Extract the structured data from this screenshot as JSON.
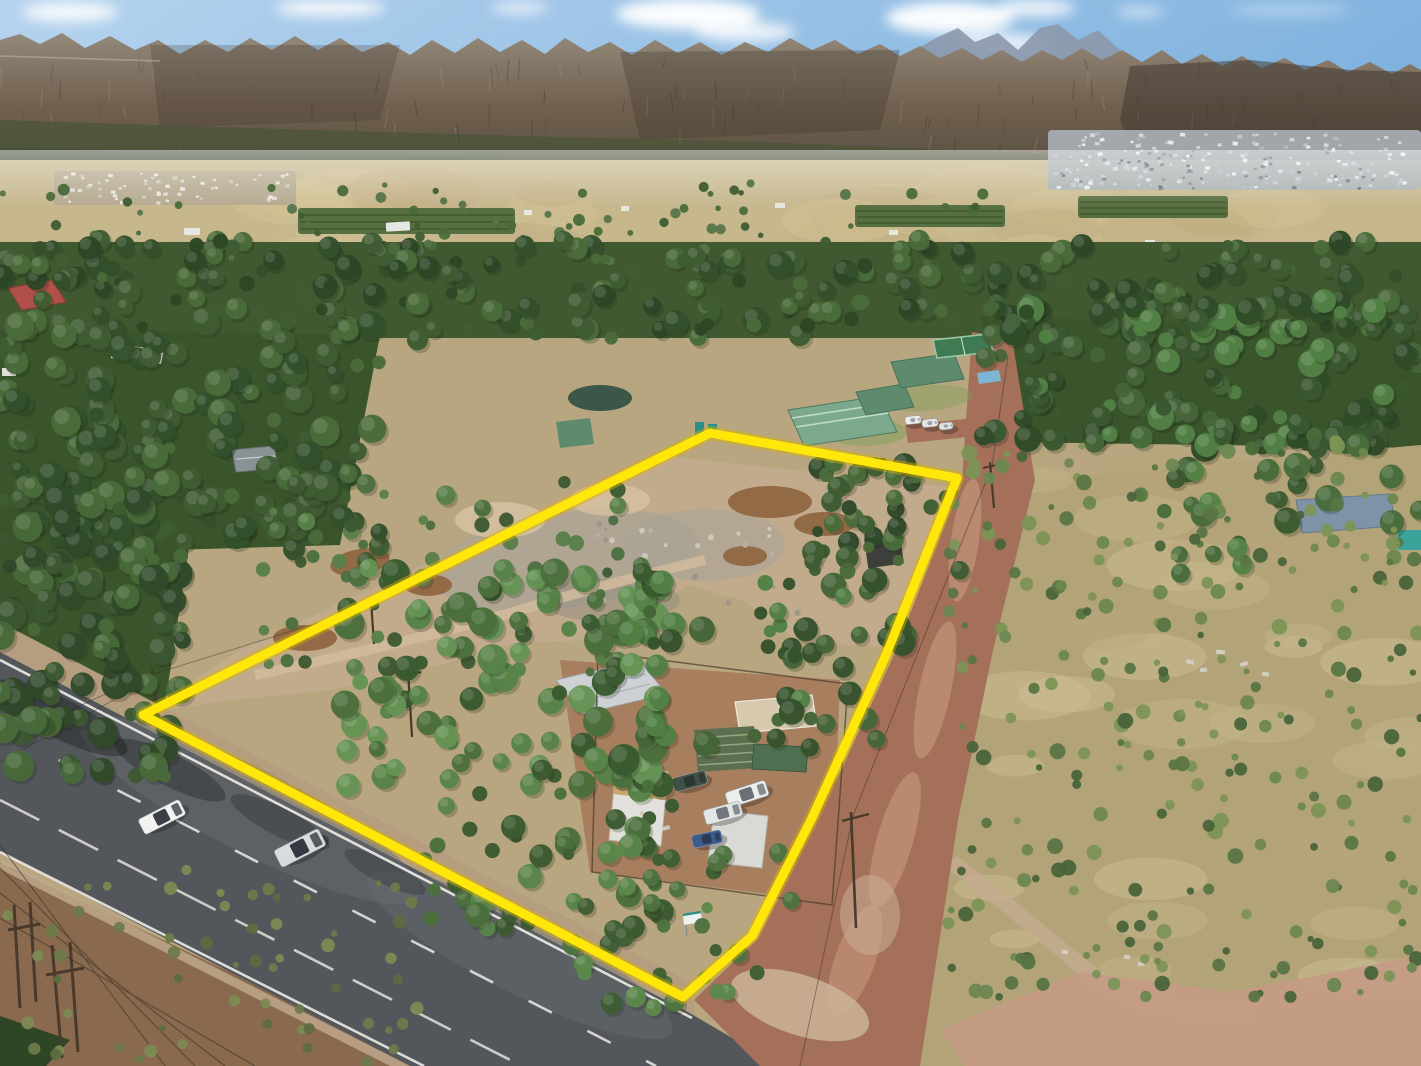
{
  "scene": {
    "description": "Aerial drone photograph of a rural smallholding outlined with a thick yellow boundary, beside a tarred main road with two cars, a red dirt road on the right, dense eucalyptus and pine trees, dry scrubland, green-roofed neighbouring farm buildings, and a long rocky mountain range with a town at its foot under a blue sky with clouds.",
    "type": "aerial-drone-photo"
  },
  "colors": {
    "sky_left": "#b6d3ee",
    "sky_right": "#7fb2de",
    "sky_low": "#cfe2f2",
    "cloud": "#ffffff",
    "peak_far": "#8c98ab",
    "mtn_top": "#93897a",
    "mtn_mid": "#71604f",
    "mtn_low": "#4e4a3b",
    "mtn_shadow": "#3c342b",
    "mtn_light": "#a79b88",
    "mtn_green": "#4a5438",
    "foothill": "#46513a",
    "valley_base": "#c6b78d",
    "orchard": "#566f40",
    "orchard_dark": "#42582f",
    "town_base": "#a9b0b6",
    "township_base": "#b5a98f",
    "ground_base": "#b7a67f",
    "forest_base": "#415930",
    "forest_base2": "#3a552c",
    "sand_clear": "#c2ab8d",
    "sand_gray": "#a9a396",
    "sand_light": "#d2bb9c",
    "heap": "#926b46",
    "mound": "#d8c4a4",
    "scrub_base": "#b3a379",
    "scrub_pink": "#c59b85",
    "scrub_path": "#c8ab93",
    "dirt_left": "#8a6a4f",
    "vineyard": "#2e4526",
    "tar": "#53575c",
    "tar_light": "#6a6e73",
    "tar_dark": "#43474c",
    "road_white": "#eceae4",
    "shoulder": "#b59d80",
    "gravel": "#c3ac90",
    "dirt_road": "#a4705a",
    "dirt_road_light": "#c89a7e",
    "dirt_road_pale": "#cbb49a",
    "roof_green": "#7ca98c",
    "roof_green_dark": "#5e8a6e",
    "court_green": "#3e7a52",
    "pool_blue": "#7db6d4",
    "lawn": "#7da05a",
    "roof_red": "#b05048",
    "roof_white": "#d8d8d2",
    "roof_gray": "#8b9296",
    "roof_silver": "#cdd1d4",
    "canvas_tan": "#d6c9ae",
    "rows_green": "#5c6e50",
    "shed_green": "#4f7050",
    "cottage_white": "#e2e0da",
    "cottage_roof": "#c8a76c",
    "caravan_white": "#d9dad5",
    "container_dark": "#3c3f3a",
    "pond": "#3c5648",
    "portaloo": "#2e8f86",
    "blue_roof": "#7e93a8",
    "teal_tank": "#3aa39a",
    "pole": "#4a3a2c",
    "wire": "#2f2a24",
    "shadow": "#1c2414",
    "boundary": "#ffe70a",
    "boundary_glow": "#d9b400",
    "sign_white": "#eef2f3",
    "sign_teal": "#2e8f86",
    "debris": "#d2cec4"
  },
  "boundary": {
    "points": "143,715 710,433 957,478 886,655 812,818 752,936 683,997",
    "stroke_width": 9,
    "glow_width": 14
  },
  "vehicles": {
    "road_cars": [
      {
        "name": "white-sedan-car",
        "x": 162,
        "y": 817,
        "angle": -27,
        "len": 46,
        "wid": 17,
        "body": "#f2f3f1",
        "glass": "#3a3f46"
      },
      {
        "name": "silver-suv-car",
        "x": 300,
        "y": 848,
        "angle": -27,
        "len": 50,
        "wid": 19,
        "body": "#d9dcdd",
        "glass": "#343a41"
      }
    ],
    "yard_vehicles": [
      {
        "name": "dark-green-car",
        "x": 690,
        "y": 781,
        "angle": -15,
        "len": 34,
        "wid": 14,
        "body": "#415047",
        "glass": "#2c3531"
      },
      {
        "name": "white-pickup-1",
        "x": 747,
        "y": 794,
        "angle": -18,
        "len": 42,
        "wid": 16,
        "body": "#eceeed",
        "glass": "#6b7076"
      },
      {
        "name": "white-pickup-2",
        "x": 723,
        "y": 813,
        "angle": -15,
        "len": 38,
        "wid": 15,
        "body": "#e3e6e5",
        "glass": "#70767c"
      },
      {
        "name": "blue-hatchback",
        "x": 707,
        "y": 839,
        "angle": -12,
        "len": 30,
        "wid": 13,
        "body": "#3c5c8e",
        "glass": "#2a3a52"
      }
    ],
    "neighbor_vehicles": [
      {
        "name": "white-car-1",
        "x": 913,
        "y": 420,
        "angle": -6,
        "len": 16,
        "wid": 8,
        "body": "#ececea",
        "glass": "#9aa0a4"
      },
      {
        "name": "white-car-2",
        "x": 930,
        "y": 423,
        "angle": -6,
        "len": 16,
        "wid": 8,
        "body": "#e4e6e6",
        "glass": "#9aa0a4"
      },
      {
        "name": "white-car-3",
        "x": 946,
        "y": 426,
        "angle": -6,
        "len": 14,
        "wid": 7,
        "body": "#dfe2e2",
        "glass": "#9aa0a4"
      }
    ]
  },
  "vegetation": {
    "regions": [
      {
        "layer": "bg-trees",
        "name": "valley-trees",
        "x": 0,
        "y": 183,
        "w": 1000,
        "h": 80,
        "count": 80,
        "rmin": 2.5,
        "rmax": 6,
        "seed": 11,
        "shape": "bush",
        "palette": [
          "#3f5c33",
          "#4a6b3a",
          "#55754a"
        ]
      },
      {
        "layer": "bg-trees",
        "name": "forest-band",
        "x": 0,
        "y": 240,
        "w": 1421,
        "h": 100,
        "count": 240,
        "rmin": 5,
        "rmax": 13,
        "seed": 12,
        "shape": "tree",
        "palette": [
          "#34502b",
          "#3f5c33",
          "#4a6b3a",
          "#2d4726"
        ]
      },
      {
        "layer": "bg-trees",
        "name": "forest-right-deep",
        "x": 980,
        "y": 300,
        "w": 441,
        "h": 150,
        "count": 150,
        "rmin": 6,
        "rmax": 14,
        "seed": 13,
        "shape": "tree",
        "palette": [
          "#3a5831",
          "#46653a",
          "#528044",
          "#2f4b28"
        ]
      },
      {
        "layer": "bg-trees",
        "name": "forest-left-deep",
        "x": 0,
        "y": 320,
        "w": 380,
        "h": 230,
        "count": 150,
        "rmin": 6,
        "rmax": 15,
        "seed": 14,
        "shape": "tree",
        "palette": [
          "#33512b",
          "#3f5c33",
          "#4a6b3a"
        ]
      },
      {
        "layer": "bg-trees",
        "name": "forest-left-road",
        "x": 0,
        "y": 500,
        "w": 190,
        "h": 280,
        "count": 95,
        "rmin": 6,
        "rmax": 16,
        "seed": 15,
        "shape": "tree",
        "palette": [
          "#31492a",
          "#3c5832",
          "#486939"
        ]
      },
      {
        "layer": "bg-trees",
        "name": "property-upper-strip",
        "x": 230,
        "y": 480,
        "w": 400,
        "h": 195,
        "count": 60,
        "rmin": 4,
        "rmax": 10,
        "seed": 16,
        "shape": "tree",
        "palette": [
          "#3e5a33",
          "#4c7040",
          "#5a8049"
        ]
      },
      {
        "layer": "bg-trees",
        "name": "property-northeast-trees",
        "x": 810,
        "y": 460,
        "w": 150,
        "h": 120,
        "count": 40,
        "rmin": 5,
        "rmax": 12,
        "seed": 17,
        "shape": "tree",
        "palette": [
          "#31492a",
          "#3e5c33",
          "#4a6b3a"
        ]
      },
      {
        "layer": "fg-trees",
        "name": "property-central-trees",
        "x": 340,
        "y": 560,
        "w": 330,
        "h": 230,
        "count": 95,
        "rmin": 7,
        "rmax": 16,
        "seed": 18,
        "shape": "tree",
        "palette": [
          "#3a5a30",
          "#4a6f3c",
          "#578347",
          "#659455"
        ]
      },
      {
        "layer": "fg-trees",
        "name": "property-east-trees",
        "x": 630,
        "y": 580,
        "w": 280,
        "h": 170,
        "count": 55,
        "rmin": 6,
        "rmax": 13,
        "seed": 19,
        "shape": "tree",
        "palette": [
          "#35522c",
          "#446538",
          "#528044"
        ]
      },
      {
        "layer": "fg-trees",
        "name": "property-south-trees",
        "x": 420,
        "y": 750,
        "w": 260,
        "h": 180,
        "count": 50,
        "rmin": 6,
        "rmax": 13,
        "seed": 20,
        "shape": "tree",
        "palette": [
          "#3c5a31",
          "#4a6f3c",
          "#5a8549"
        ]
      },
      {
        "layer": "fg-trees",
        "name": "roadside-south-trees",
        "x": 560,
        "y": 850,
        "w": 240,
        "h": 170,
        "count": 35,
        "rmin": 5,
        "rmax": 11,
        "seed": 21,
        "shape": "tree",
        "palette": [
          "#3f5e34",
          "#4d7340",
          "#5c884b"
        ]
      },
      {
        "layer": "fg-trees",
        "name": "right-pine-cluster",
        "x": 1140,
        "y": 430,
        "w": 281,
        "h": 150,
        "count": 30,
        "rmin": 7,
        "rmax": 14,
        "seed": 22,
        "shape": "tree",
        "palette": [
          "#3b5a31",
          "#486c3b",
          "#568246"
        ]
      },
      {
        "layer": "scrub",
        "name": "scrub-bushes",
        "x": 945,
        "y": 440,
        "w": 476,
        "h": 560,
        "count": 260,
        "rmin": 3,
        "rmax": 8,
        "seed": 23,
        "shape": "bush",
        "palette": [
          "#5a7544",
          "#6d8751",
          "#49643a",
          "#7d9456"
        ]
      },
      {
        "layer": "scrub",
        "name": "left-dirt-tufts",
        "x": 0,
        "y": 870,
        "w": 420,
        "h": 196,
        "count": 60,
        "rmin": 3,
        "rmax": 7,
        "seed": 24,
        "shape": "bush",
        "palette": [
          "#6e7a4a",
          "#7d8a52",
          "#5d6b40"
        ]
      },
      {
        "layer": "terrain-rubble",
        "name": "rubble-row",
        "x": 585,
        "y": 520,
        "w": 240,
        "h": 100,
        "count": 28,
        "rmin": 1.5,
        "rmax": 3.5,
        "seed": 25,
        "shape": "bush",
        "palette": [
          "#cfc9bd",
          "#b8b2a6",
          "#9b958a"
        ]
      },
      {
        "layer": "town-specks",
        "name": "town-buildings",
        "x": 1055,
        "y": 133,
        "w": 350,
        "h": 55,
        "count": 170,
        "rmin": 1.2,
        "rmax": 2.6,
        "seed": 26,
        "shape": "speck",
        "palette": [
          "#e8eaec",
          "#d4d8db",
          "#c2c7cb",
          "#b2b8bd"
        ]
      },
      {
        "layer": "town-specks",
        "name": "town-roofs-dark",
        "x": 1060,
        "y": 150,
        "w": 330,
        "h": 40,
        "count": 50,
        "rmin": 1.2,
        "rmax": 2.2,
        "seed": 27,
        "shape": "speck",
        "palette": [
          "#6e7478",
          "#596065",
          "#7b8186"
        ]
      },
      {
        "layer": "township-specks",
        "name": "township-houses",
        "x": 58,
        "y": 173,
        "w": 235,
        "h": 30,
        "count": 60,
        "rmin": 1.2,
        "rmax": 2.4,
        "seed": 28,
        "shape": "speck",
        "palette": [
          "#dedcd4",
          "#cdc9bf",
          "#e8e6e0"
        ]
      },
      {
        "layer": "field-patches",
        "name": "valley-field-patches",
        "x": 0,
        "y": 190,
        "w": 1421,
        "h": 70,
        "count": 26,
        "rmin": 12,
        "rmax": 34,
        "seed": 29,
        "shape": "patch",
        "palette": [
          "#d2c397",
          "#c0ae82",
          "#cbbc90"
        ]
      },
      {
        "layer": "scrub-patches",
        "name": "scrub-dry-patches",
        "x": 950,
        "y": 470,
        "w": 470,
        "h": 520,
        "count": 36,
        "rmin": 10,
        "rmax": 30,
        "seed": 30,
        "shape": "patch",
        "palette": [
          "#c4b58a",
          "#cfc096",
          "#b7a77c"
        ]
      },
      {
        "layer": "mountain-texture",
        "name": "rock-streaks",
        "x": 0,
        "y": 58,
        "w": 1421,
        "h": 95,
        "count": 110,
        "rmin": 5,
        "rmax": 12,
        "seed": 31,
        "shape": "streak",
        "palette": [
          "#3a332c",
          "#a79b88",
          "#544a40"
        ]
      }
    ]
  }
}
